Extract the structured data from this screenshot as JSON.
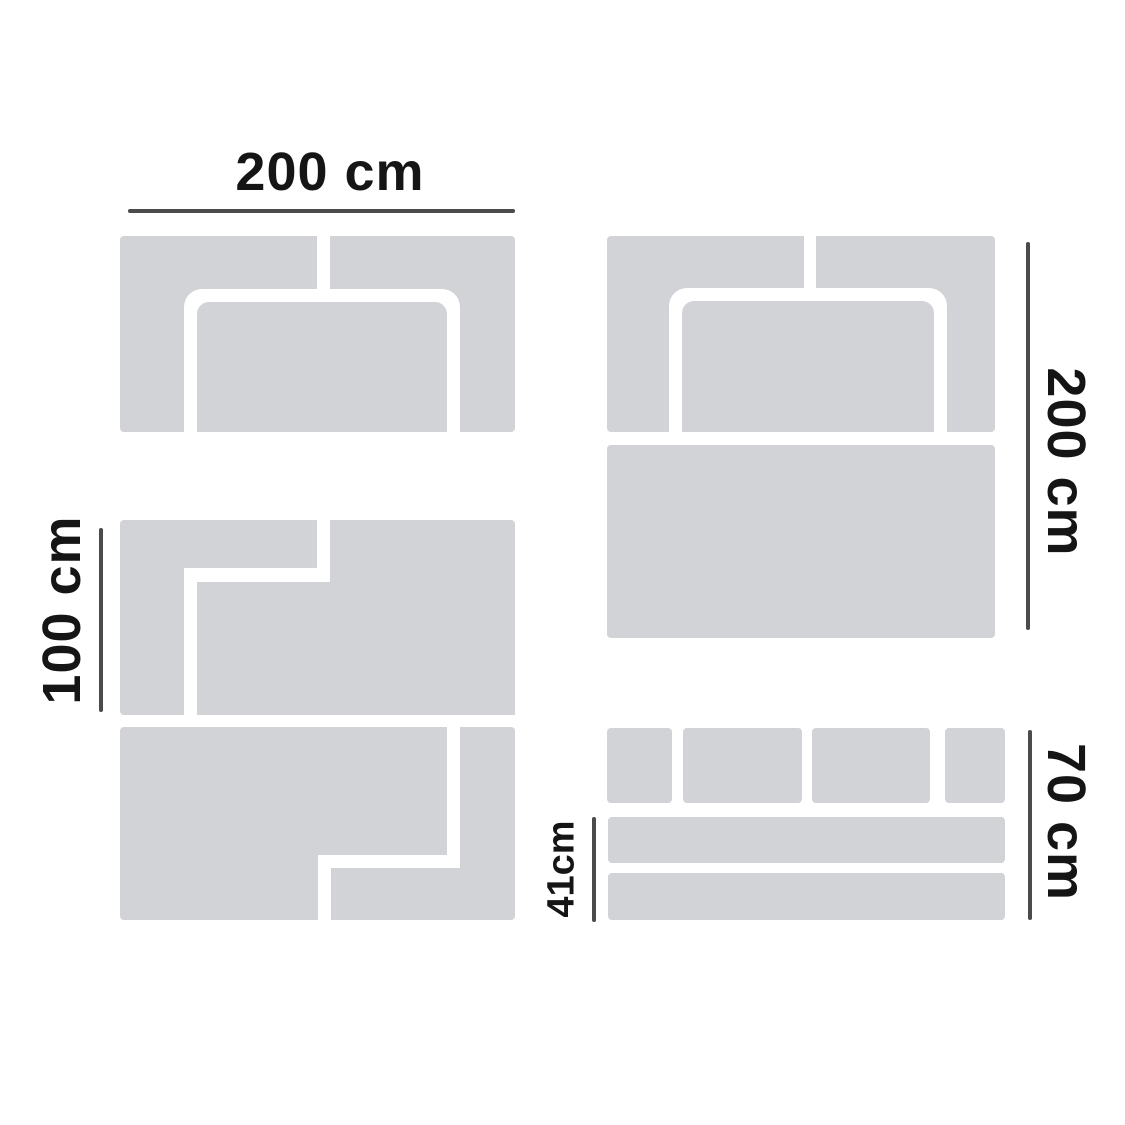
{
  "canvas": {
    "width": 1125,
    "height": 1125,
    "background": "#ffffff"
  },
  "colors": {
    "panel_gray": "#d2d3d6",
    "seam_white": "#ffffff",
    "measure_line_gray": "#4b4b4b",
    "label_text": "#151515"
  },
  "labels": {
    "top_width": "200 cm",
    "left_height": "100 cm",
    "right_height": "200 cm",
    "bottom_right_height": "70 cm",
    "bottom_strip_height": "41cm"
  },
  "diagram": {
    "type": "dimension-diagram",
    "panels": [
      {
        "id": "top-left-panel",
        "measured_by": [
          "top_width"
        ]
      },
      {
        "id": "middle-left-panel",
        "measured_by": [
          "left_height"
        ]
      },
      {
        "id": "bottom-left-panel",
        "measured_by": []
      },
      {
        "id": "top-right-panel",
        "measured_by": [
          "right_height"
        ]
      },
      {
        "id": "middle-right-panel",
        "measured_by": [
          "right_height"
        ]
      },
      {
        "id": "bottom-right-piece-group",
        "measured_by": [
          "bottom_right_height",
          "bottom_strip_height"
        ]
      }
    ]
  }
}
